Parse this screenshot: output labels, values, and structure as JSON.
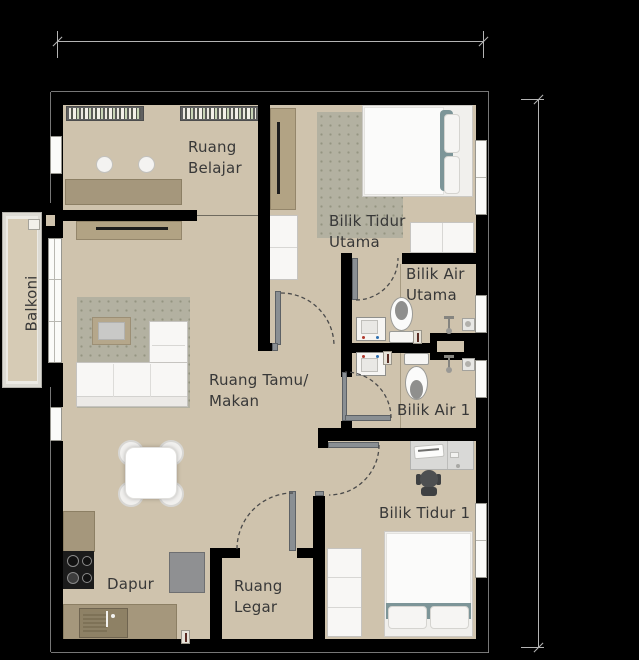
{
  "rooms": {
    "study": {
      "line1": "Ruang",
      "line2": "Belajar"
    },
    "master_bedroom": {
      "line1": "Bilik Tidur",
      "line2": "Utama"
    },
    "master_bathroom": {
      "line1": "Bilik Air",
      "line2": "Utama"
    },
    "bathroom1": {
      "label": "Bilik Air 1"
    },
    "living_dining": {
      "line1": "Ruang Tamu/",
      "line2": "Makan"
    },
    "bedroom1": {
      "label": "Bilik Tidur 1"
    },
    "kitchen": {
      "label": "Dapur"
    },
    "foyer": {
      "line1": "Ruang",
      "line2": "Legar"
    },
    "balcony": {
      "label": "Balkoni"
    }
  },
  "colors": {
    "background": "#000000",
    "floor": "#cfc3ad",
    "balcony_floor": "#d6cbb5",
    "rug": "#b3b1a1",
    "wall": "#000000",
    "wood": "#a5977c",
    "console": "#b2a384",
    "white_furniture": "#f8f7f5",
    "teal": "#7d9598",
    "door_leaf": "#8a8f93",
    "text": "#383838",
    "dim_line": "#b4b4b4",
    "appliance_gray": "#8f9092",
    "cooktop": "#1b1b1b",
    "outline": "#8c8c8c",
    "arc": "#4a4a4a"
  }
}
